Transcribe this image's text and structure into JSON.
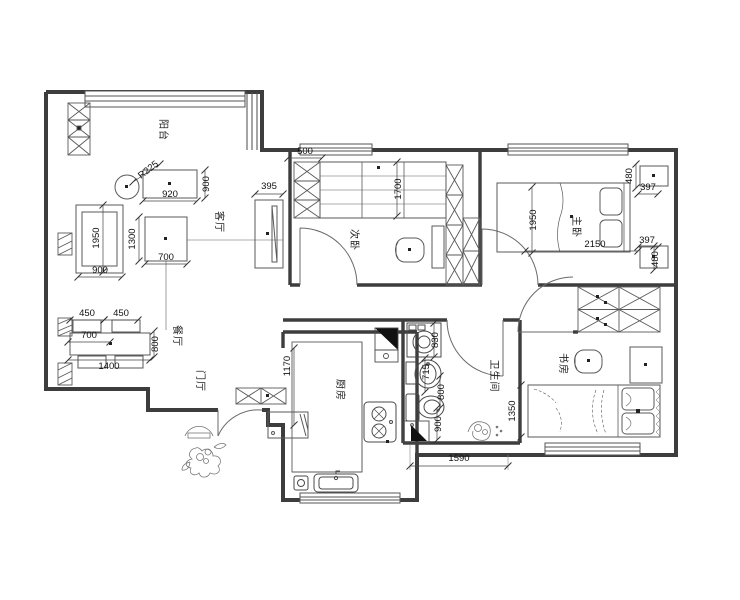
{
  "drawing": {
    "type": "apartment-floor-plan",
    "background_color": "#ffffff",
    "wall_color": "#3d3d3d",
    "furniture_color": "#5a5a5a",
    "text_color": "#111111"
  },
  "rooms": [
    {
      "id": "balcony",
      "label": "阳台",
      "x": 160,
      "y": 130,
      "rotate": 90
    },
    {
      "id": "living-room",
      "label": "客厅",
      "x": 216,
      "y": 222,
      "rotate": 90
    },
    {
      "id": "dining-room",
      "label": "餐厅",
      "x": 174,
      "y": 336,
      "rotate": 90
    },
    {
      "id": "entry-hall",
      "label": "门厅",
      "x": 197,
      "y": 381,
      "rotate": 90
    },
    {
      "id": "bedroom-2",
      "label": "次卧",
      "x": 351,
      "y": 240,
      "rotate": 90
    },
    {
      "id": "master-bedroom",
      "label": "主卧",
      "x": 573,
      "y": 227,
      "rotate": 90
    },
    {
      "id": "study",
      "label": "书房",
      "x": 560,
      "y": 364,
      "rotate": 90
    },
    {
      "id": "bathroom",
      "label": "卫生间",
      "x": 491,
      "y": 376,
      "rotate": 90
    },
    {
      "id": "kitchen",
      "label": "厨房",
      "x": 337,
      "y": 390,
      "rotate": 90
    }
  ],
  "dimensions": [
    {
      "v": "500",
      "x": 305,
      "y": 154,
      "rotate": 0,
      "x1": 288,
      "y1": 158,
      "x2": 322,
      "y2": 158
    },
    {
      "v": "395",
      "x": 269,
      "y": 189,
      "rotate": 0,
      "x1": 255,
      "y1": 194,
      "x2": 283,
      "y2": 194
    },
    {
      "v": "920",
      "x": 170,
      "y": 197,
      "rotate": 0,
      "x1": 143,
      "y1": 201,
      "x2": 197,
      "y2": 201
    },
    {
      "v": "900",
      "x": 209,
      "y": 184,
      "rotate": -90,
      "x1": 205,
      "y1": 170,
      "x2": 205,
      "y2": 198
    },
    {
      "v": "R225",
      "x": 150,
      "y": 172,
      "rotate": -38,
      "x1": 133,
      "y1": 182,
      "x2": 160,
      "y2": 164
    },
    {
      "v": "1950",
      "x": 99,
      "y": 238,
      "rotate": -90,
      "x1": 103,
      "y1": 205,
      "x2": 103,
      "y2": 272
    },
    {
      "v": "1300",
      "x": 135,
      "y": 239,
      "rotate": -90,
      "x1": 139,
      "y1": 217,
      "x2": 139,
      "y2": 261
    },
    {
      "v": "700",
      "x": 166,
      "y": 260,
      "rotate": 0,
      "x1": 145,
      "y1": 264,
      "x2": 187,
      "y2": 264
    },
    {
      "v": "900",
      "x": 100,
      "y": 273,
      "rotate": 0,
      "x1": 78,
      "y1": 277,
      "x2": 122,
      "y2": 277
    },
    {
      "v": "450",
      "x": 87,
      "y": 316,
      "rotate": 0,
      "x1": 70,
      "y1": 320,
      "x2": 104,
      "y2": 320
    },
    {
      "v": "450",
      "x": 121,
      "y": 316,
      "rotate": 0,
      "x1": 104,
      "y1": 320,
      "x2": 138,
      "y2": 320
    },
    {
      "v": "700",
      "x": 89,
      "y": 338,
      "rotate": 0,
      "x1": 68,
      "y1": 342,
      "x2": 110,
      "y2": 342
    },
    {
      "v": "1400",
      "x": 109,
      "y": 369,
      "rotate": 0,
      "x1": 68,
      "y1": 360,
      "x2": 150,
      "y2": 360
    },
    {
      "v": "800",
      "x": 158,
      "y": 344,
      "rotate": -90,
      "x1": 154,
      "y1": 331,
      "x2": 154,
      "y2": 357
    },
    {
      "v": "1700",
      "x": 401,
      "y": 189,
      "rotate": -90,
      "x1": 397,
      "y1": 162,
      "x2": 397,
      "y2": 216
    },
    {
      "v": "480",
      "x": 632,
      "y": 176,
      "rotate": -90,
      "x1": 636,
      "y1": 164,
      "x2": 636,
      "y2": 188
    },
    {
      "v": "397",
      "x": 648,
      "y": 190,
      "rotate": 0,
      "x1": 638,
      "y1": 194,
      "x2": 658,
      "y2": 194
    },
    {
      "v": "1950",
      "x": 536,
      "y": 220,
      "rotate": -90,
      "x1": 532,
      "y1": 187,
      "x2": 532,
      "y2": 253
    },
    {
      "v": "2150",
      "x": 595,
      "y": 247,
      "rotate": 0,
      "x1": 525,
      "y1": 251,
      "x2": 638,
      "y2": 251
    },
    {
      "v": "397",
      "x": 647,
      "y": 243,
      "rotate": 0,
      "x1": 638,
      "y1": 247,
      "x2": 658,
      "y2": 247
    },
    {
      "v": "480",
      "x": 658,
      "y": 259,
      "rotate": -90,
      "x1": 654,
      "y1": 246,
      "x2": 654,
      "y2": 270
    },
    {
      "v": "1170",
      "x": 290,
      "y": 366,
      "rotate": -90,
      "x1": 294,
      "y1": 348,
      "x2": 294,
      "y2": 425
    },
    {
      "v": "830",
      "x": 438,
      "y": 340,
      "rotate": -90,
      "x1": 434,
      "y1": 323,
      "x2": 434,
      "y2": 357
    },
    {
      "v": "715",
      "x": 429,
      "y": 372,
      "rotate": -90,
      "x1": 425,
      "y1": 358,
      "x2": 425,
      "y2": 392
    },
    {
      "v": "800",
      "x": 444,
      "y": 392,
      "rotate": -90,
      "x1": 440,
      "y1": 376,
      "x2": 440,
      "y2": 408
    },
    {
      "v": "900",
      "x": 441,
      "y": 424,
      "rotate": -90,
      "x1": 437,
      "y1": 408,
      "x2": 437,
      "y2": 440
    },
    {
      "v": "1350",
      "x": 515,
      "y": 411,
      "rotate": -90,
      "x1": 521,
      "y1": 385,
      "x2": 521,
      "y2": 437
    },
    {
      "v": "1590",
      "x": 459,
      "y": 461,
      "rotate": 0,
      "x1": 410,
      "y1": 466,
      "x2": 508,
      "y2": 466
    }
  ]
}
